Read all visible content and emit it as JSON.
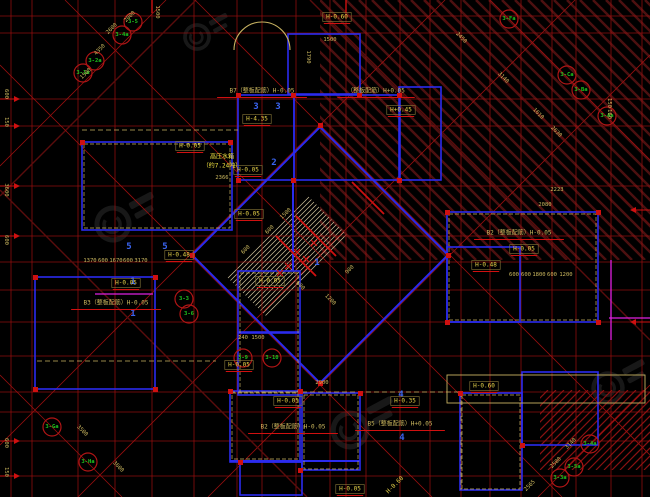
{
  "meta": {
    "type": "autocad-floor-plan-viewport",
    "bg": "#000000"
  },
  "palette": {
    "grid": "#9e1010",
    "grid_dark": "#5f0d0d",
    "band": "#4c1010",
    "slope": "#8a1212",
    "wall": "#2b2bee",
    "khaki": "#c7b261",
    "dim": "#cdb95f",
    "label": "#e8d44a",
    "bright": "#f5e642",
    "red": "#d01010",
    "green": "#1ec41e",
    "bubble": "#b01515",
    "digit": "#3a64f0",
    "magenta": "#e020e0",
    "stair": "#cfc49c",
    "watermark": "#2d2d2d"
  },
  "grid": {
    "v": [
      11,
      32,
      78,
      115,
      152,
      194,
      237,
      262,
      296,
      330,
      346,
      366,
      400,
      430,
      461,
      490,
      521,
      552,
      576,
      611,
      642
    ],
    "h": [
      16,
      33,
      99,
      126,
      186,
      236,
      262,
      290,
      322,
      356,
      392,
      412,
      441,
      476
    ]
  },
  "diagonals": [
    [
      0,
      166,
      166,
      0,
      0
    ],
    [
      0,
      196,
      196,
      0,
      1
    ],
    [
      0,
      445,
      445,
      0,
      0
    ],
    [
      78,
      497,
      575,
      0,
      0
    ],
    [
      208,
      497,
      650,
      55,
      0
    ],
    [
      538,
      497,
      650,
      385,
      0
    ],
    [
      490,
      0,
      650,
      160,
      0
    ],
    [
      65,
      0,
      562,
      497,
      0
    ],
    [
      0,
      65,
      432,
      497,
      0
    ],
    [
      195,
      0,
      650,
      455,
      0
    ],
    [
      0,
      375,
      122,
      497,
      0
    ],
    [
      0,
      190,
      307,
      497,
      1
    ],
    [
      310,
      0,
      650,
      340,
      1
    ],
    [
      425,
      0,
      650,
      225,
      1
    ]
  ],
  "bands": [
    {
      "x": 320,
      "y": 0,
      "w": 330,
      "h": 260,
      "dir": "b",
      "gap": 13,
      "lw": 2.5,
      "c": "band"
    },
    {
      "x": 540,
      "y": 390,
      "w": 110,
      "h": 80,
      "dir": "f",
      "gap": 8,
      "lw": 1.2,
      "c": "slope"
    }
  ],
  "stair": {
    "poly": [
      307,
      195,
      348,
      236,
      267,
      317,
      226,
      276
    ],
    "gap": 5,
    "lw": 0.7
  },
  "walls": [
    [
      288,
      34,
      72,
      60
    ],
    [
      238,
      95,
      56,
      85
    ],
    [
      294,
      95,
      106,
      85
    ],
    [
      399,
      87,
      42,
      93
    ],
    [
      82,
      142,
      150,
      88
    ],
    [
      35,
      277,
      120,
      112
    ],
    [
      238,
      271,
      62,
      61
    ],
    [
      238,
      333,
      62,
      62
    ],
    [
      447,
      212,
      151,
      110
    ],
    [
      447,
      247,
      73,
      75
    ],
    [
      230,
      391,
      70,
      71
    ],
    [
      302,
      393,
      58,
      77
    ],
    [
      240,
      462,
      62,
      33
    ],
    [
      460,
      393,
      62,
      97
    ],
    [
      522,
      372,
      76,
      73
    ]
  ],
  "wall_poly": [
    320,
    127,
    448,
    255,
    320,
    383,
    192,
    255
  ],
  "wall_segs": [
    [
      293,
      180,
      293,
      271
    ],
    [
      230,
      461,
      360,
      461
    ]
  ],
  "dashed_rects": [
    [
      84,
      144,
      146,
      84
    ],
    [
      449,
      214,
      147,
      106
    ],
    [
      232,
      393,
      66,
      66
    ],
    [
      462,
      395,
      58,
      94
    ],
    [
      304,
      395,
      54,
      74
    ],
    [
      240,
      273,
      58,
      119
    ]
  ],
  "khaki_lines": [
    [
      82,
      130,
      238,
      130
    ],
    [
      37,
      361,
      216,
      361
    ],
    [
      230,
      392,
      460,
      392
    ],
    [
      461,
      392,
      461,
      490
    ]
  ],
  "khaki_rects": [
    [
      447,
      375,
      198,
      28
    ]
  ],
  "door_arc": "M234,50 A28,28 0 0 1 290,50",
  "magenta": [
    [
      609,
      318,
      650,
      318
    ],
    [
      95,
      294,
      153,
      294
    ],
    [
      611,
      260,
      611,
      340
    ]
  ],
  "red_segs": [
    [
      296,
      216,
      336,
      256
    ],
    [
      276,
      236,
      316,
      276
    ],
    [
      352,
      182,
      384,
      214
    ]
  ],
  "xmarks": [
    [
      297,
      252
    ],
    [
      306,
      259
    ],
    [
      288,
      266
    ],
    [
      314,
      243
    ],
    [
      280,
      273
    ]
  ],
  "columns": [
    [
      318,
      123
    ],
    [
      446,
      253
    ],
    [
      318,
      381
    ],
    [
      190,
      253
    ],
    [
      236,
      93
    ],
    [
      291,
      93
    ],
    [
      357,
      93
    ],
    [
      397,
      93
    ],
    [
      236,
      178
    ],
    [
      291,
      178
    ],
    [
      397,
      178
    ],
    [
      80,
      140
    ],
    [
      228,
      140
    ],
    [
      33,
      275
    ],
    [
      153,
      275
    ],
    [
      33,
      387
    ],
    [
      153,
      387
    ],
    [
      445,
      210
    ],
    [
      596,
      210
    ],
    [
      445,
      320
    ],
    [
      596,
      320
    ],
    [
      228,
      389
    ],
    [
      298,
      389
    ],
    [
      358,
      391
    ],
    [
      458,
      391
    ],
    [
      520,
      443
    ],
    [
      298,
      468
    ],
    [
      238,
      460
    ]
  ],
  "arrows": {
    "left_y": [
      99,
      126,
      186,
      236,
      441,
      476
    ],
    "right_y": [
      210,
      322
    ],
    "top_x": [
      152,
      346
    ]
  },
  "watermarks": [
    [
      197,
      37,
      0.75
    ],
    [
      113,
      224,
      1
    ],
    [
      350,
      430,
      1.05
    ],
    [
      608,
      388,
      0.9
    ]
  ],
  "bubbles": [
    [
      "3-5",
      133,
      22
    ],
    [
      "3-4a",
      122,
      35
    ],
    [
      "3-2a",
      95,
      61
    ],
    [
      "3-1a",
      83,
      73
    ],
    [
      "3-Fa",
      509,
      19
    ],
    [
      "3-Ca",
      567,
      75
    ],
    [
      "3-Ba",
      581,
      90
    ],
    [
      "3-Aa",
      607,
      116
    ],
    [
      "3-3",
      184,
      299
    ],
    [
      "3-6",
      189,
      314
    ],
    [
      "3-9",
      243,
      358
    ],
    [
      "3-10",
      272,
      358
    ],
    [
      "3-Ga",
      52,
      427
    ],
    [
      "3-Ha",
      88,
      462
    ],
    [
      "3-4a",
      590,
      444
    ],
    [
      "3-5a",
      574,
      467
    ],
    [
      "3-3a",
      560,
      478
    ]
  ],
  "digits": [
    [
      "3",
      256,
      107
    ],
    [
      "3",
      278,
      107
    ],
    [
      "2",
      274,
      163
    ],
    [
      "5",
      129,
      247
    ],
    [
      "5",
      165,
      247
    ],
    [
      "1",
      133,
      282
    ],
    [
      "1",
      133,
      314
    ],
    [
      "4",
      401,
      395
    ],
    [
      "4",
      402,
      438
    ],
    [
      "1",
      317,
      263
    ]
  ],
  "labels": [
    [
      "H-0.60",
      337,
      17,
      1
    ],
    [
      "H-4.35",
      257,
      119,
      1
    ],
    [
      "H-0.05",
      248,
      170,
      1
    ],
    [
      "H-0.05",
      249,
      214,
      1
    ],
    [
      "H+0.45",
      401,
      110,
      1
    ],
    [
      "H-0.48",
      179,
      255,
      1
    ],
    [
      "H-0.05",
      126,
      283,
      1
    ],
    [
      "H-0.05",
      190,
      146,
      1
    ],
    [
      "H-0.48",
      486,
      265,
      1
    ],
    [
      "H-0.05",
      524,
      249,
      1
    ],
    [
      "H-0.05",
      288,
      401,
      1
    ],
    [
      "H-0.35",
      405,
      401,
      1
    ],
    [
      "H-0.60",
      484,
      386,
      1
    ],
    [
      "H-0.05",
      239,
      365,
      1
    ],
    [
      "H-0.05",
      350,
      489,
      1
    ],
    [
      "H-0.05",
      270,
      281,
      1
    ],
    [
      "H-0.60",
      395,
      485,
      0,
      -45
    ],
    [
      "B7（整板配筋）H-0.05",
      262,
      91,
      2,
      0,
      "dim"
    ],
    [
      "（整板配筋）H+0.05",
      376,
      91,
      2,
      0,
      "dim"
    ],
    [
      "B2（整板配筋）H-0.05",
      519,
      233,
      2,
      0,
      "dim"
    ],
    [
      "B3（整板配筋）H-0.05",
      116,
      303,
      2,
      0,
      "dim"
    ],
    [
      "B2（整板配筋）H-0.05",
      293,
      427,
      2,
      0,
      "dim"
    ],
    [
      "B5（整板配筋）H+0.05",
      400,
      424,
      2,
      0,
      "dim"
    ],
    [
      "高压水箱",
      222,
      157,
      0,
      0,
      "bright"
    ],
    [
      "（约7.24吨）",
      222,
      166,
      0,
      0,
      "bright"
    ]
  ],
  "dims": [
    [
      "2600",
      112,
      29,
      -45
    ],
    [
      "4350",
      100,
      50,
      -45
    ],
    [
      "1500",
      86,
      74,
      -45
    ],
    [
      "2000",
      130,
      17,
      -45
    ],
    [
      "2450",
      461,
      38,
      45
    ],
    [
      "3140",
      503,
      78,
      45
    ],
    [
      "1610",
      538,
      114,
      45
    ],
    [
      "2630",
      556,
      132,
      45
    ],
    [
      "3500",
      82,
      431,
      45
    ],
    [
      "3600",
      118,
      467,
      45
    ],
    [
      "3140",
      571,
      444,
      -45
    ],
    [
      "2580",
      556,
      463,
      -45
    ],
    [
      "2565",
      530,
      486,
      -45
    ],
    [
      "2366",
      222,
      178,
      0
    ],
    [
      "2223",
      557,
      190,
      0
    ],
    [
      "2080",
      545,
      205,
      0
    ],
    [
      "2900",
      322,
      383,
      0
    ],
    [
      "240",
      243,
      338,
      0
    ],
    [
      "1500",
      258,
      338,
      0
    ],
    [
      "1370",
      90,
      261,
      0
    ],
    [
      "600",
      103,
      261,
      0
    ],
    [
      "1670",
      116,
      261,
      0
    ],
    [
      "600",
      128,
      261,
      0
    ],
    [
      "3170",
      141,
      261,
      0
    ],
    [
      "600",
      514,
      275,
      0
    ],
    [
      "600",
      526,
      275,
      0
    ],
    [
      "1800",
      539,
      275,
      0
    ],
    [
      "600",
      552,
      275,
      0
    ],
    [
      "1200",
      566,
      275,
      0
    ],
    [
      "1790",
      308,
      57,
      90
    ],
    [
      "1500",
      330,
      40,
      0
    ],
    [
      "1500",
      157,
      12,
      90
    ],
    [
      "150",
      609,
      103,
      90
    ],
    [
      "160",
      609,
      114,
      90
    ],
    [
      "600",
      6,
      94,
      90
    ],
    [
      "150",
      6,
      122,
      90
    ],
    [
      "3600",
      6,
      190,
      90
    ],
    [
      "600",
      6,
      240,
      90
    ],
    [
      "600",
      6,
      443,
      90
    ],
    [
      "150",
      6,
      472,
      90
    ],
    [
      "600",
      270,
      230,
      -45
    ],
    [
      "1500",
      286,
      214,
      -45
    ],
    [
      "600",
      300,
      286,
      45
    ],
    [
      "1200",
      330,
      300,
      45
    ],
    [
      "900",
      350,
      270,
      -45
    ],
    [
      "600",
      246,
      250,
      -45
    ]
  ]
}
